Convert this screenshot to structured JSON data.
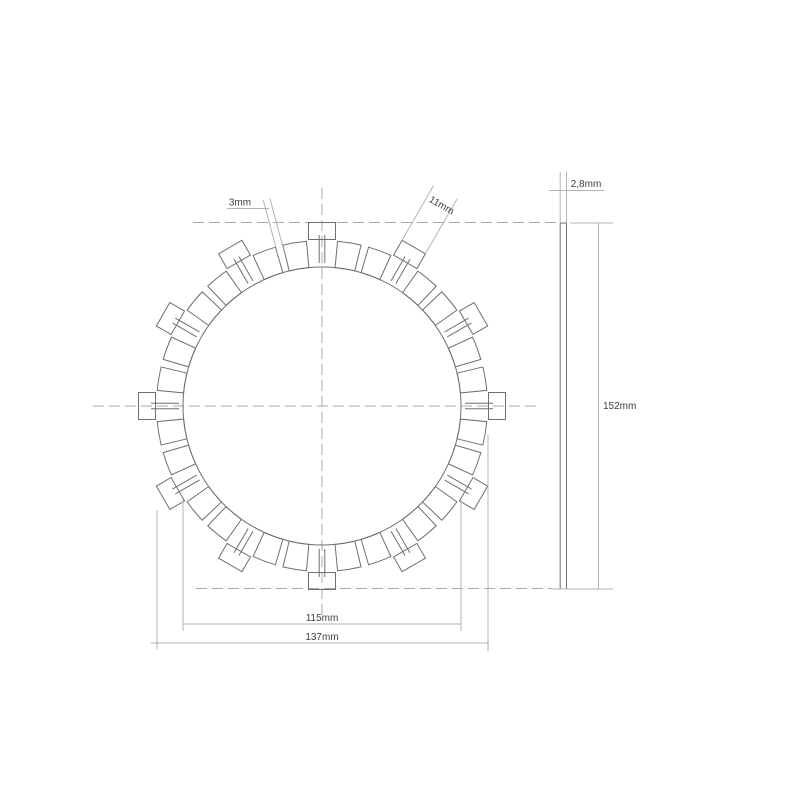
{
  "drawing": {
    "labels": {
      "groove_width": "3mm",
      "tab_width": "11mm",
      "thickness": "2,8mm",
      "overall_diameter": "152mm",
      "friction_inner_diameter": "115mm",
      "friction_outer_diameter": "137mm"
    },
    "colors": {
      "background": "#ffffff",
      "outline": "#6f6f6f",
      "dimension": "#b3b3b3",
      "centerline": "#a9a9a9",
      "text": "#3f3f3f"
    }
  }
}
